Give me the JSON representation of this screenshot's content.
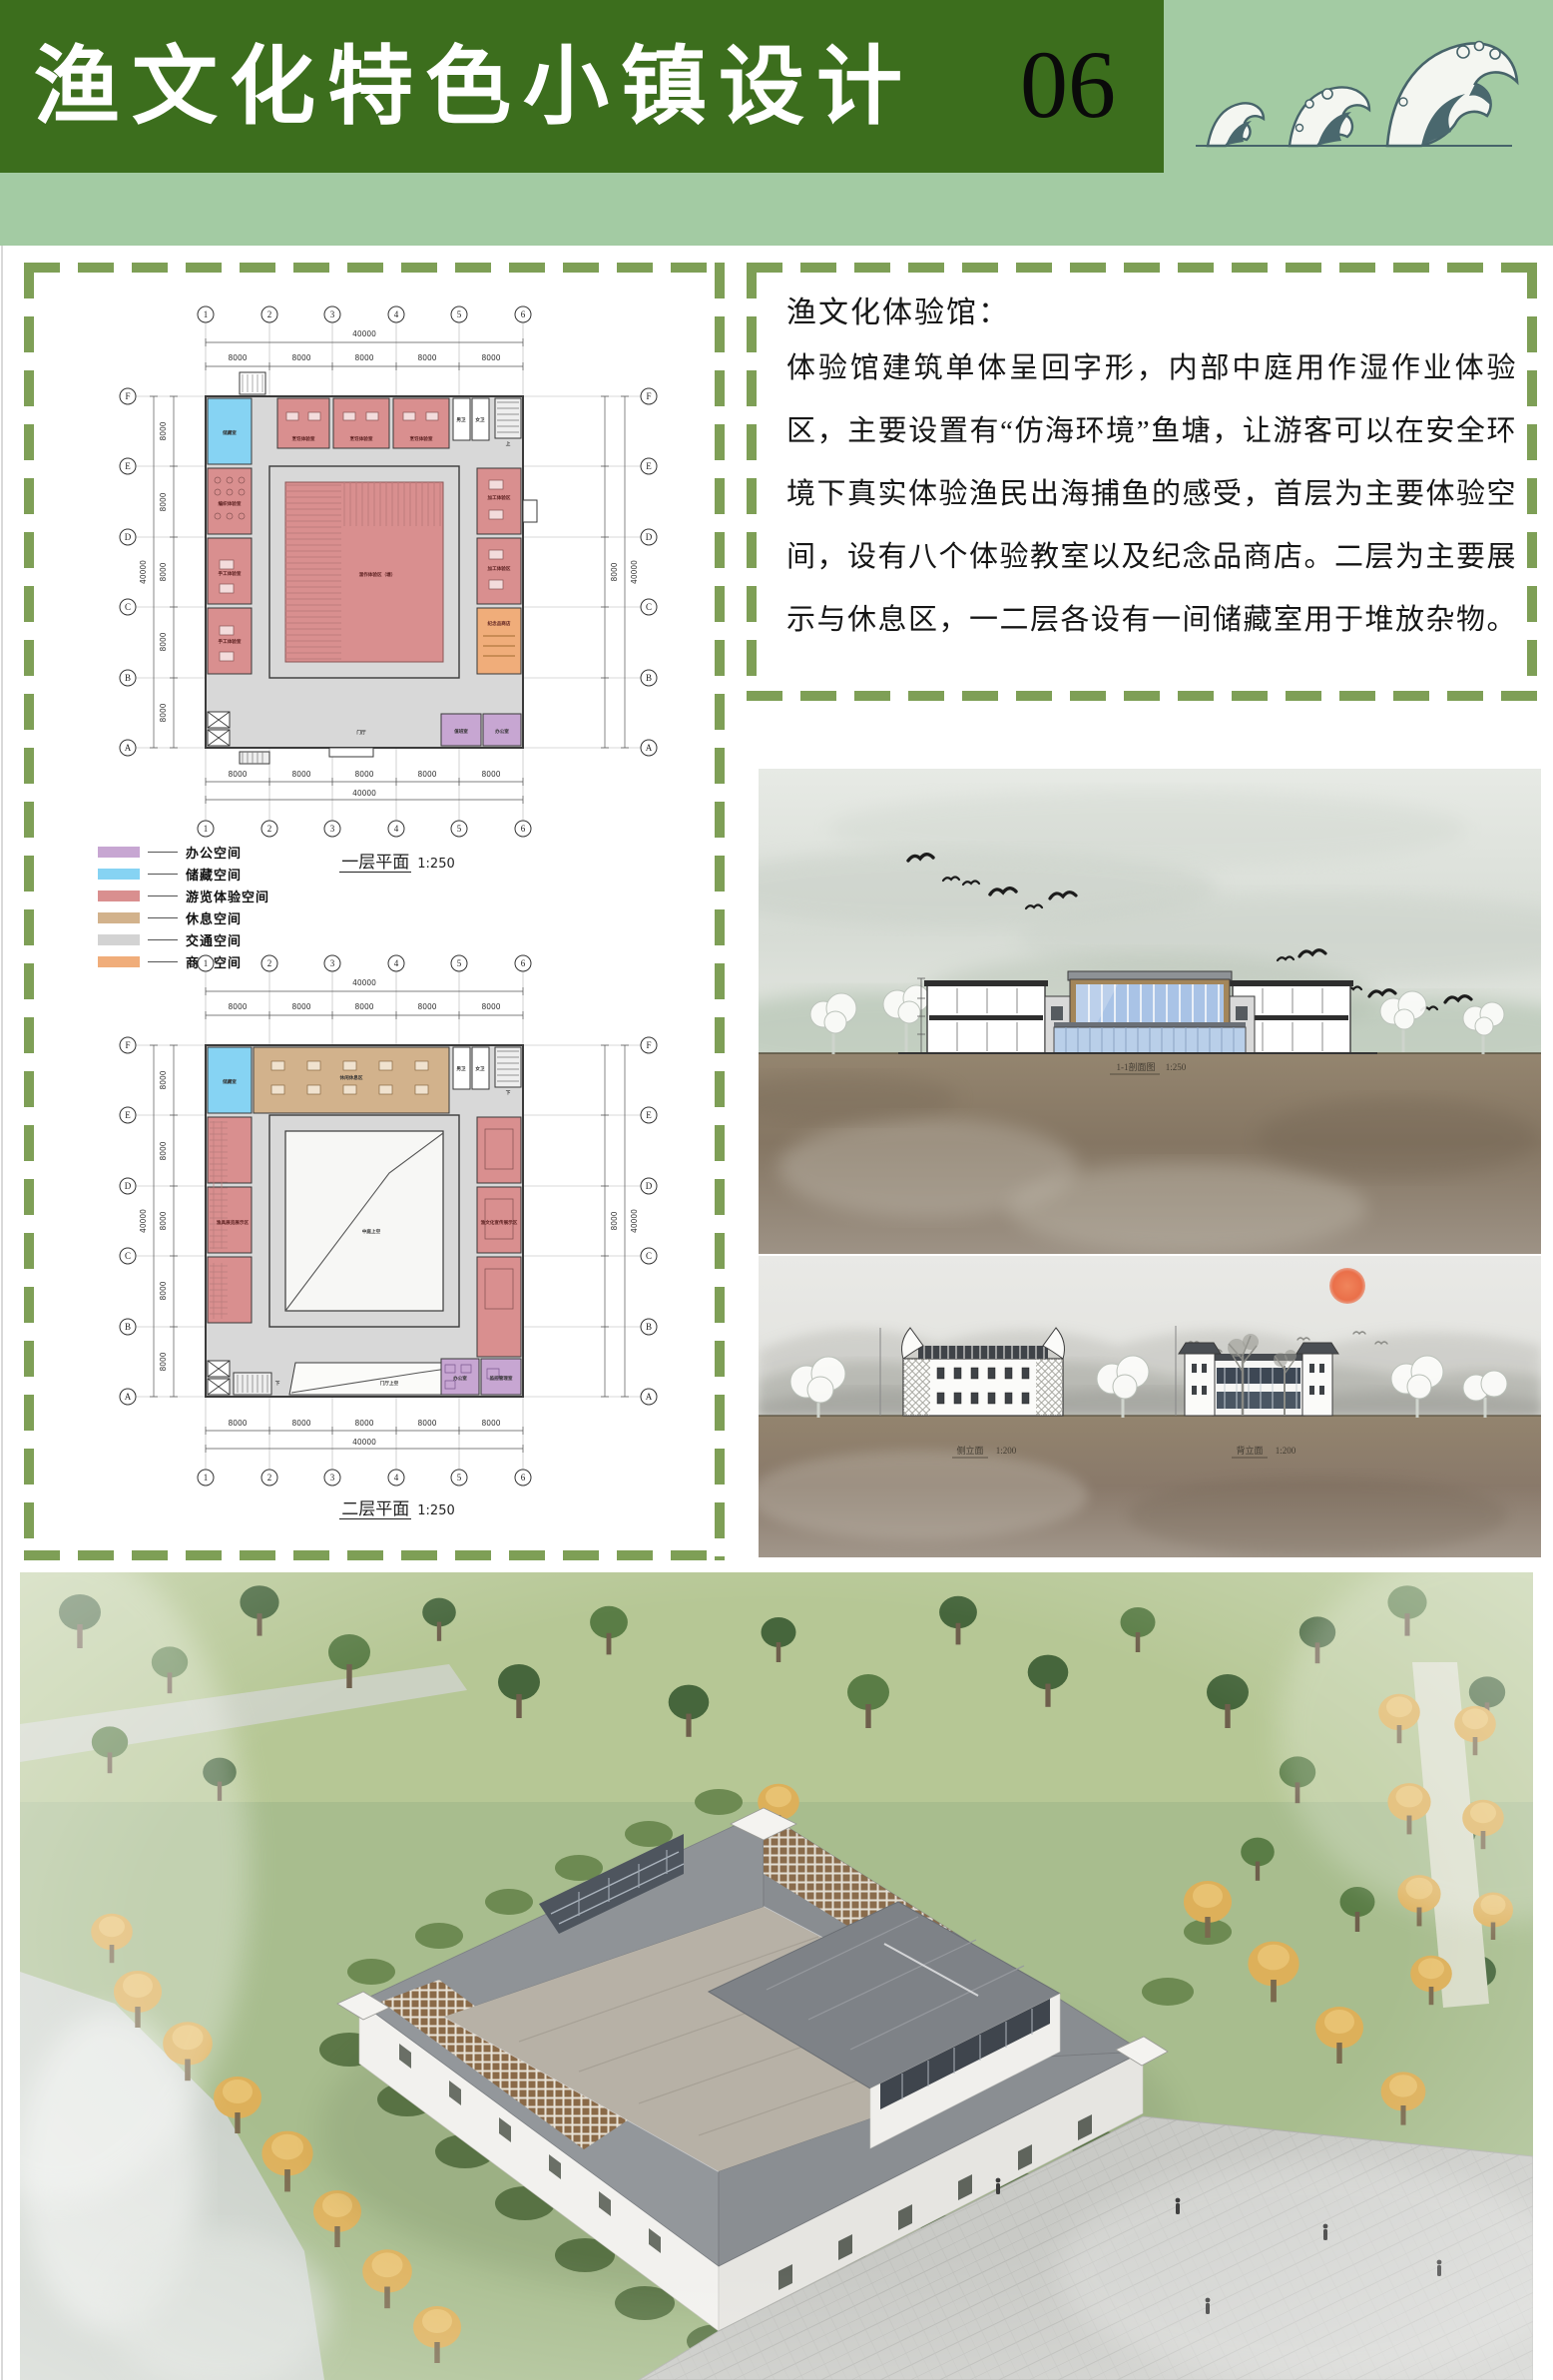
{
  "header": {
    "title": "渔文化特色小镇设计",
    "page_number": "06",
    "colors": {
      "dark_green": "#3c6e1d",
      "light_green": "#a3cba3",
      "dash_green": "#7e9f56"
    }
  },
  "intro": {
    "title": "渔文化体验馆：",
    "body": "体验馆建筑单体呈回字形，内部中庭用作湿作业体验区，主要设置有“仿海环境”鱼塘，让游客可以在安全环境下真实体验渔民出海捕鱼的感受，首层为主要体验空间，设有八个体验教室以及纪念品商店。二层为主要展示与休息区，一二层各设有一间储藏室用于堆放杂物。"
  },
  "legend": {
    "items": [
      {
        "label": "办公空间",
        "color": "#c7a6d2"
      },
      {
        "label": "储藏空间",
        "color": "#86d3f3"
      },
      {
        "label": "游览体验空间",
        "color": "#d98f8f"
      },
      {
        "label": "休息空间",
        "color": "#d2b28c"
      },
      {
        "label": "交通空间",
        "color": "#d3d3d3"
      },
      {
        "label": "商业空间",
        "color": "#f0ad7a"
      }
    ]
  },
  "plans": {
    "grid_cols": [
      "1",
      "2",
      "3",
      "4",
      "5",
      "6"
    ],
    "grid_rows": [
      "F",
      "E",
      "D",
      "C",
      "B",
      "A"
    ],
    "total_dim": "40000",
    "bay_dim": "8000",
    "floor1": {
      "caption": "一层平面",
      "scale": "1:250",
      "rooms": {
        "storage": "储藏室",
        "class1": "烹饪体验室",
        "class2": "烹饪体验室",
        "class3": "烹饪体验室",
        "wc_m": "男卫",
        "wc_f": "女卫",
        "left1": "编织体验室",
        "left2": "手工体验室",
        "left3": "手工体验室",
        "right1": "加工体验区",
        "right2": "加工体验区",
        "shop": "纪念品商店",
        "duty": "值班室",
        "office": "办公室",
        "lobby": "门厅",
        "courtyard": "湿作体验区（塘）",
        "up": "上"
      }
    },
    "floor2": {
      "caption": "二层平面",
      "scale": "1:250",
      "rooms": {
        "storage": "储藏室",
        "rest": "休闲休息区",
        "wc_m": "男卫",
        "wc_f": "女卫",
        "left": "渔具展览展示区",
        "right": "渔文化宣传展示区",
        "void": "中庭上空",
        "lobby_void": "门厅上空",
        "office": "办公室",
        "monitor": "监控管理室",
        "down": "下"
      }
    }
  },
  "drawings": {
    "section": {
      "caption": "1-1剖面图",
      "scale": "1:250"
    },
    "elev_side": {
      "caption": "侧立面",
      "scale": "1:200"
    },
    "elev_back": {
      "caption": "背立面",
      "scale": "1:200"
    }
  }
}
